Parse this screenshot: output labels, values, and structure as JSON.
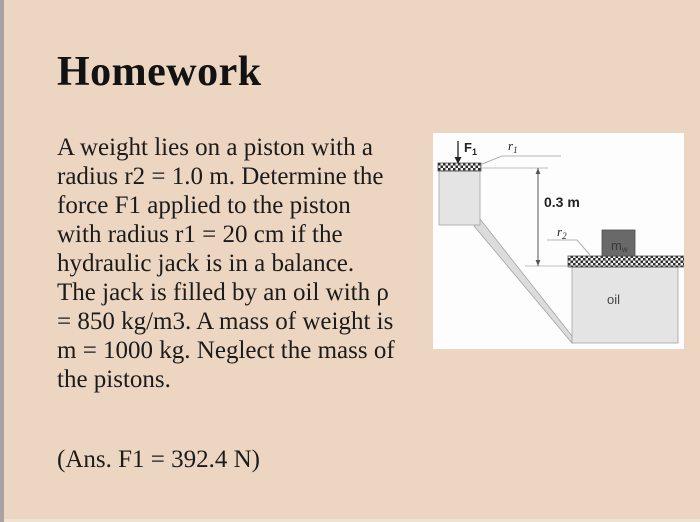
{
  "slide": {
    "title": "Homework",
    "problem_lines": [
      "A weight lies on a piston with a",
      "radius r2 = 1.0 m. Determine the",
      "force F1 applied to the piston",
      "with radius r1 = 20 cm if the",
      "hydraulic jack is in a balance.",
      "The jack is filled by an oil with ρ",
      "= 850 kg/m3. A mass of weight is",
      "m = 1000 kg. Neglect the mass of",
      "the pistons."
    ],
    "answer": "(Ans. F1 = 392.4 N)"
  },
  "diagram": {
    "force_label": "F",
    "force_sub": "1",
    "r1_label": "r",
    "r1_sub": "1",
    "r2_label": "r",
    "r2_sub": "2",
    "height_dimension": "0.3 m",
    "mass_label": "m",
    "mass_sub": "w",
    "oil_label": "oil"
  },
  "colors": {
    "slide_bg": "#ecd6c2",
    "left_strip": "#a9a2a3",
    "text": "#1b1b1b",
    "diagram_bg": "#fdfdfd",
    "piston_fill": "#e4e4e4",
    "tube_fill": "#dcdcdc",
    "weight_block_fill": "#696969",
    "hatch_dark": "#2d2d2d"
  }
}
